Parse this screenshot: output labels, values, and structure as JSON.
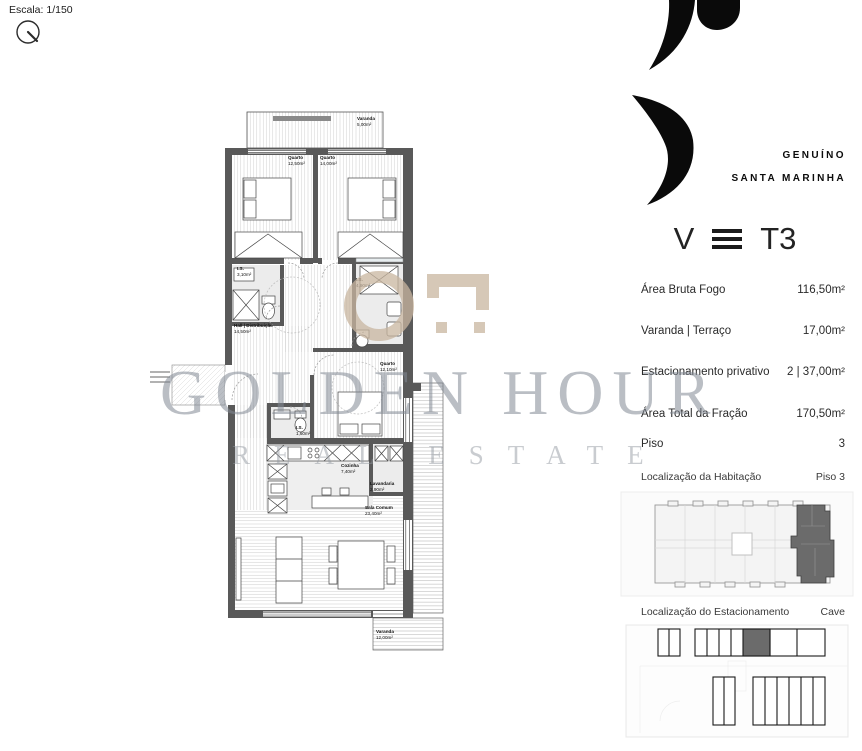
{
  "scale": {
    "label": "Escala: 1/150"
  },
  "brand": {
    "line1": "GENUÍNO",
    "line2": "SANTA MARINHA"
  },
  "typology": {
    "left": "V",
    "right": "T3"
  },
  "details": [
    {
      "label": "Área Bruta Fogo",
      "value": "116,50m²"
    },
    {
      "label": "Varanda | Terraço",
      "value": "17,00m²"
    },
    {
      "label": "Estacionamento privativo",
      "value": "2 | 37,00m²"
    },
    {
      "label": "Área Total da Fração",
      "value": "170,50m²"
    },
    {
      "label": "Piso",
      "value": "3"
    }
  ],
  "locations": [
    {
      "title": "Localização da Habitação",
      "value": "Piso 3"
    },
    {
      "title": "Localização do Estacionamento",
      "value": "Cave"
    }
  ],
  "watermark": {
    "line1": "GOLDEN HOUR",
    "line2": "REAL ESTATE"
  },
  "floorplan": {
    "rooms": [
      {
        "name": "Varanda",
        "area": "5,00m²"
      },
      {
        "name": "Quarto",
        "area": "12,50m²"
      },
      {
        "name": "Quarto",
        "area": "14,00m²"
      },
      {
        "name": "I.S.",
        "area": "3,10m²"
      },
      {
        "name": "I.S.",
        "area": "4,90m²"
      },
      {
        "name": "Hall | Distribuição",
        "area": "14,50m²"
      },
      {
        "name": "Quarto",
        "area": "12,10m²"
      },
      {
        "name": "I.S.",
        "area": "1,60m²"
      },
      {
        "name": "Cozinha",
        "area": "7,40m²"
      },
      {
        "name": "Lavandaria",
        "area": "2,90m²"
      },
      {
        "name": "Sala Comum",
        "area": "23,40m²"
      },
      {
        "name": "Varanda",
        "area": "12,00m²"
      }
    ]
  }
}
